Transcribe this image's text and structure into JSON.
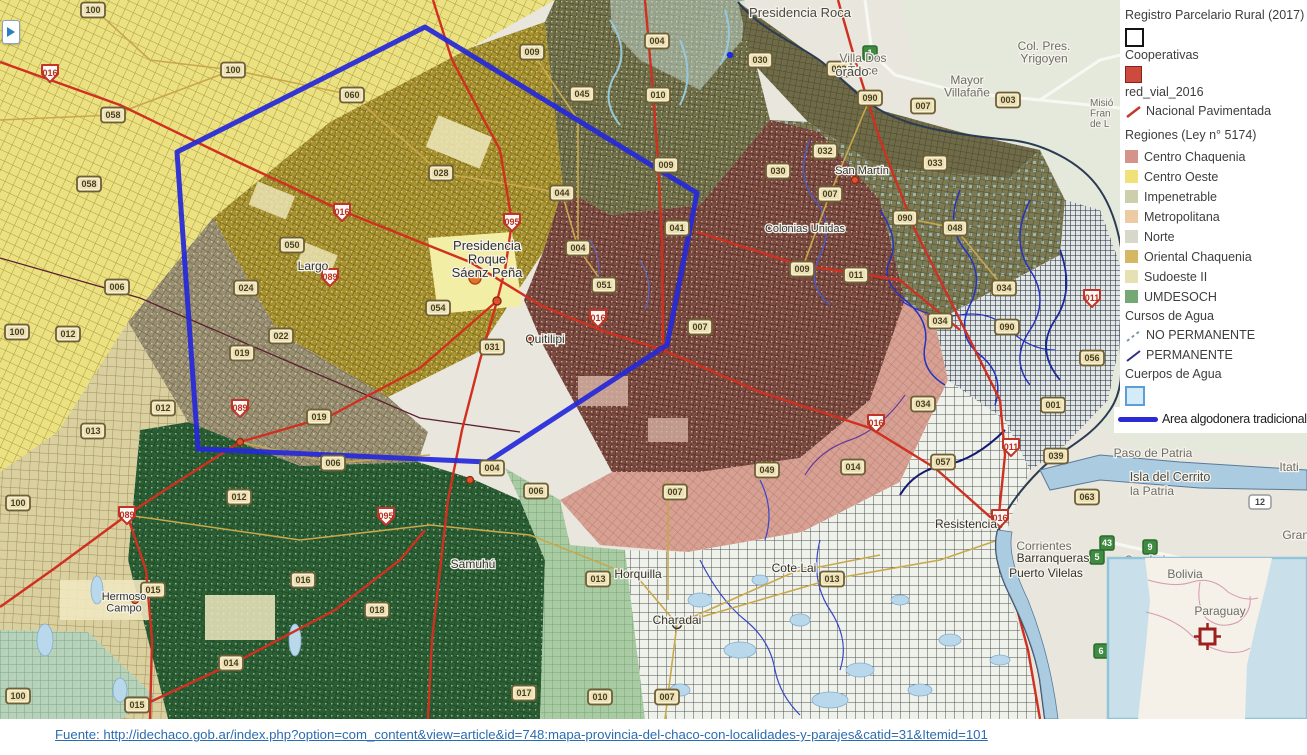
{
  "legend": {
    "title_registro": "Registro Parcelario Rural (2017)",
    "cooperativas_label": "Cooperativas",
    "cooperativas_swatch_color": "#ffffff",
    "red_vial_label": "red_vial_2016",
    "red_vial_swatch_color": "#cd4a3e",
    "nacional_pavimentada_label": "Nacional Pavimentada",
    "regiones_title": "Regiones (Ley n° 5174)",
    "regions": [
      {
        "label": "Centro Chaquenia",
        "color": "#d4948c"
      },
      {
        "label": "Centro Oeste",
        "color": "#f0e178"
      },
      {
        "label": "Impenetrable",
        "color": "#cdceac"
      },
      {
        "label": "Metropolitana",
        "color": "#eccaa2"
      },
      {
        "label": "Norte",
        "color": "#d8d8ca"
      },
      {
        "label": "Oriental Chaquenia",
        "color": "#d6b864"
      },
      {
        "label": "Sudoeste II",
        "color": "#e7e0b2"
      },
      {
        "label": "UMDESOCH",
        "color": "#74a874"
      }
    ],
    "cursos_title": "Cursos de Agua",
    "no_permanente_label": "NO PERMANENTE",
    "permanente_label": "PERMANENTE",
    "cuerpos_title": "Cuerpos de Agua",
    "cuerpos_swatch_color": "#d4ecf7",
    "area_algodonera_label": "Area algodonera tradicional",
    "area_line_color": "#2b2bd5"
  },
  "map": {
    "labels": [
      {
        "text": "Presidencia Roca",
        "x": 800,
        "y": 17,
        "size": 13,
        "color": "#4a4a44"
      },
      {
        "text": "Villa Dos\nTrece",
        "x": 863,
        "y": 62,
        "size": 12
      },
      {
        "text": "Mayor\nVillafañe",
        "x": 967,
        "y": 84,
        "size": 12
      },
      {
        "text": "Col. Pres.\nYrigoyen",
        "x": 1044,
        "y": 50,
        "size": 12
      },
      {
        "text": "orado",
        "x": 852,
        "y": 76,
        "size": 13,
        "color": "#4a4a44"
      },
      {
        "text": "Misió\nFran\nde L",
        "x": 1090,
        "y": 106,
        "size": 10,
        "anchor": "start"
      },
      {
        "text": "Paso de Patria",
        "x": 1153,
        "y": 457,
        "size": 12
      },
      {
        "text": "Isla del Cerrito",
        "x": 1170,
        "y": 481,
        "size": 12.5,
        "color": "#4a4a44"
      },
      {
        "text": "la Patria",
        "x": 1152,
        "y": 495,
        "size": 12
      },
      {
        "text": "Itati",
        "x": 1289,
        "y": 471,
        "size": 12
      },
      {
        "text": "Grand",
        "x": 1299,
        "y": 539,
        "size": 12
      },
      {
        "text": "San Luis",
        "x": 1148,
        "y": 564,
        "size": 12
      },
      {
        "text": "Presidencia\nRoque\nSáenz Peña",
        "x": 487,
        "y": 250,
        "size": 13,
        "color": "#33332e"
      },
      {
        "text": "Largo",
        "x": 313,
        "y": 270,
        "size": 12,
        "color": "#33332e"
      },
      {
        "text": "Quitilipi",
        "x": 545,
        "y": 343,
        "size": 12,
        "color": "#33332e"
      },
      {
        "text": "Samuhú",
        "x": 473,
        "y": 568,
        "size": 12,
        "color": "#33332e"
      },
      {
        "text": "Horquilla",
        "x": 638,
        "y": 578,
        "size": 12,
        "color": "#33332e"
      },
      {
        "text": "Charadai",
        "x": 677,
        "y": 624,
        "size": 12,
        "color": "#33332e"
      },
      {
        "text": "Cote Lai",
        "x": 794,
        "y": 572,
        "size": 12,
        "color": "#33332e"
      },
      {
        "text": "Resistencia",
        "x": 966,
        "y": 528,
        "size": 12,
        "color": "#33332e"
      },
      {
        "text": "Corrientes",
        "x": 1044,
        "y": 550,
        "size": 12
      },
      {
        "text": "Barranqueras",
        "x": 1053,
        "y": 562,
        "size": 12,
        "color": "#33332e"
      },
      {
        "text": "Puerto Vilelas",
        "x": 1046,
        "y": 577,
        "size": 12,
        "color": "#33332e"
      },
      {
        "text": "Hermoso\nCampo",
        "x": 124,
        "y": 600,
        "size": 11,
        "color": "#33332e"
      },
      {
        "text": "Colonias Unidas",
        "x": 805,
        "y": 232,
        "size": 11,
        "color": "#33332e"
      },
      {
        "text": "San Martín",
        "x": 862,
        "y": 174,
        "size": 11,
        "color": "#33332e"
      }
    ],
    "shields": [
      {
        "label": "016",
        "type": "n",
        "x": 50,
        "y": 73
      },
      {
        "label": "058",
        "type": "p",
        "x": 113,
        "y": 115
      },
      {
        "label": "058",
        "type": "p",
        "x": 89,
        "y": 184
      },
      {
        "label": "100",
        "type": "p",
        "x": 93,
        "y": 10
      },
      {
        "label": "100",
        "type": "p",
        "x": 233,
        "y": 70
      },
      {
        "label": "060",
        "type": "p",
        "x": 352,
        "y": 95
      },
      {
        "label": "009",
        "type": "p",
        "x": 532,
        "y": 52
      },
      {
        "label": "004",
        "type": "p",
        "x": 657,
        "y": 41
      },
      {
        "label": "045",
        "type": "p",
        "x": 582,
        "y": 94
      },
      {
        "label": "010",
        "type": "p",
        "x": 658,
        "y": 95
      },
      {
        "label": "009",
        "type": "p",
        "x": 666,
        "y": 165
      },
      {
        "label": "028",
        "type": "p",
        "x": 441,
        "y": 173
      },
      {
        "label": "044",
        "type": "p",
        "x": 562,
        "y": 193
      },
      {
        "label": "016",
        "type": "n",
        "x": 342,
        "y": 212
      },
      {
        "label": "095",
        "type": "n",
        "x": 512,
        "y": 222
      },
      {
        "label": "050",
        "type": "p",
        "x": 292,
        "y": 245
      },
      {
        "label": "024",
        "type": "p",
        "x": 246,
        "y": 288
      },
      {
        "label": "089",
        "type": "n",
        "x": 330,
        "y": 277
      },
      {
        "label": "006",
        "type": "p",
        "x": 117,
        "y": 287
      },
      {
        "label": "022",
        "type": "p",
        "x": 281,
        "y": 336
      },
      {
        "label": "019",
        "type": "p",
        "x": 242,
        "y": 353
      },
      {
        "label": "012",
        "type": "p",
        "x": 68,
        "y": 334
      },
      {
        "label": "100",
        "type": "p",
        "x": 17,
        "y": 332
      },
      {
        "label": "013",
        "type": "p",
        "x": 93,
        "y": 431
      },
      {
        "label": "012",
        "type": "p",
        "x": 163,
        "y": 408
      },
      {
        "label": "089",
        "type": "n",
        "x": 240,
        "y": 408
      },
      {
        "label": "019",
        "type": "p",
        "x": 319,
        "y": 417
      },
      {
        "label": "006",
        "type": "p",
        "x": 333,
        "y": 463
      },
      {
        "label": "012",
        "type": "p",
        "x": 239,
        "y": 497
      },
      {
        "label": "089",
        "type": "n",
        "x": 127,
        "y": 515
      },
      {
        "label": "100",
        "type": "p",
        "x": 18,
        "y": 503
      },
      {
        "label": "015",
        "type": "p",
        "x": 153,
        "y": 590
      },
      {
        "label": "016",
        "type": "p",
        "x": 303,
        "y": 580
      },
      {
        "label": "018",
        "type": "p",
        "x": 377,
        "y": 610
      },
      {
        "label": "014",
        "type": "p",
        "x": 231,
        "y": 663
      },
      {
        "label": "095",
        "type": "n",
        "x": 386,
        "y": 516
      },
      {
        "label": "015",
        "type": "p",
        "x": 137,
        "y": 705
      },
      {
        "label": "100",
        "type": "p",
        "x": 18,
        "y": 696
      },
      {
        "label": "017",
        "type": "p",
        "x": 524,
        "y": 693
      },
      {
        "label": "013",
        "type": "p",
        "x": 598,
        "y": 579
      },
      {
        "label": "010",
        "type": "p",
        "x": 600,
        "y": 697
      },
      {
        "label": "007",
        "type": "p",
        "x": 667,
        "y": 697
      },
      {
        "label": "007",
        "type": "p",
        "x": 675,
        "y": 492
      },
      {
        "label": "049",
        "type": "p",
        "x": 767,
        "y": 470
      },
      {
        "label": "006",
        "type": "p",
        "x": 536,
        "y": 491
      },
      {
        "label": "004",
        "type": "p",
        "x": 492,
        "y": 468
      },
      {
        "label": "013",
        "type": "p",
        "x": 832,
        "y": 579
      },
      {
        "label": "031",
        "type": "p",
        "x": 492,
        "y": 347
      },
      {
        "label": "054",
        "type": "p",
        "x": 438,
        "y": 308
      },
      {
        "label": "004",
        "type": "p",
        "x": 578,
        "y": 248
      },
      {
        "label": "051",
        "type": "p",
        "x": 604,
        "y": 285
      },
      {
        "label": "041",
        "type": "p",
        "x": 677,
        "y": 228
      },
      {
        "label": "007",
        "type": "p",
        "x": 700,
        "y": 327
      },
      {
        "label": "016",
        "type": "n",
        "x": 598,
        "y": 318
      },
      {
        "label": "030",
        "type": "p",
        "x": 760,
        "y": 60
      },
      {
        "label": "003",
        "type": "p",
        "x": 839,
        "y": 69
      },
      {
        "label": "090",
        "type": "p",
        "x": 870,
        "y": 98
      },
      {
        "label": "007",
        "type": "p",
        "x": 923,
        "y": 106
      },
      {
        "label": "003",
        "type": "p",
        "x": 1008,
        "y": 100
      },
      {
        "label": "032",
        "type": "p",
        "x": 825,
        "y": 151
      },
      {
        "label": "030",
        "type": "p",
        "x": 778,
        "y": 171
      },
      {
        "label": "007",
        "type": "p",
        "x": 830,
        "y": 194
      },
      {
        "label": "033",
        "type": "p",
        "x": 935,
        "y": 163
      },
      {
        "label": "090",
        "type": "p",
        "x": 905,
        "y": 218
      },
      {
        "label": "048",
        "type": "p",
        "x": 955,
        "y": 228
      },
      {
        "label": "009",
        "type": "p",
        "x": 802,
        "y": 269
      },
      {
        "label": "011",
        "type": "p",
        "x": 856,
        "y": 275
      },
      {
        "label": "011",
        "type": "n",
        "x": 1092,
        "y": 298
      },
      {
        "label": "034",
        "type": "p",
        "x": 940,
        "y": 321
      },
      {
        "label": "034",
        "type": "p",
        "x": 1004,
        "y": 288
      },
      {
        "label": "090",
        "type": "p",
        "x": 1007,
        "y": 327
      },
      {
        "label": "056",
        "type": "p",
        "x": 1092,
        "y": 358
      },
      {
        "label": "001",
        "type": "p",
        "x": 1053,
        "y": 405
      },
      {
        "label": "034",
        "type": "p",
        "x": 923,
        "y": 404
      },
      {
        "label": "039",
        "type": "p",
        "x": 1056,
        "y": 456
      },
      {
        "label": "057",
        "type": "p",
        "x": 943,
        "y": 462
      },
      {
        "label": "014",
        "type": "p",
        "x": 853,
        "y": 467
      },
      {
        "label": "016",
        "type": "n",
        "x": 876,
        "y": 423
      },
      {
        "label": "011",
        "type": "n",
        "x": 1011,
        "y": 447
      },
      {
        "label": "016",
        "type": "n",
        "x": 1000,
        "y": 518
      },
      {
        "label": "063",
        "type": "p",
        "x": 1087,
        "y": 497
      },
      {
        "label": "1",
        "type": "g",
        "x": 870,
        "y": 53
      },
      {
        "label": "43",
        "type": "g",
        "x": 1107,
        "y": 543
      },
      {
        "label": "9",
        "type": "g",
        "x": 1150,
        "y": 547
      },
      {
        "label": "5",
        "type": "g",
        "x": 1097,
        "y": 557
      },
      {
        "label": "6",
        "type": "g",
        "x": 1101,
        "y": 651
      },
      {
        "label": "12",
        "type": "w",
        "x": 1260,
        "y": 502
      }
    ],
    "inset_labels": [
      {
        "text": "Bolivia",
        "x": 1185,
        "y": 578,
        "size": 12
      },
      {
        "text": "Paraguay",
        "x": 1220,
        "y": 615,
        "size": 12
      }
    ]
  },
  "footer": {
    "source_link": "Fuente:  http://idechaco.gob.ar/index.php?option=com_content&view=article&id=748:mapa-provincia-del-chaco-con-localidades-y-parajes&catid=31&Itemid=101"
  }
}
